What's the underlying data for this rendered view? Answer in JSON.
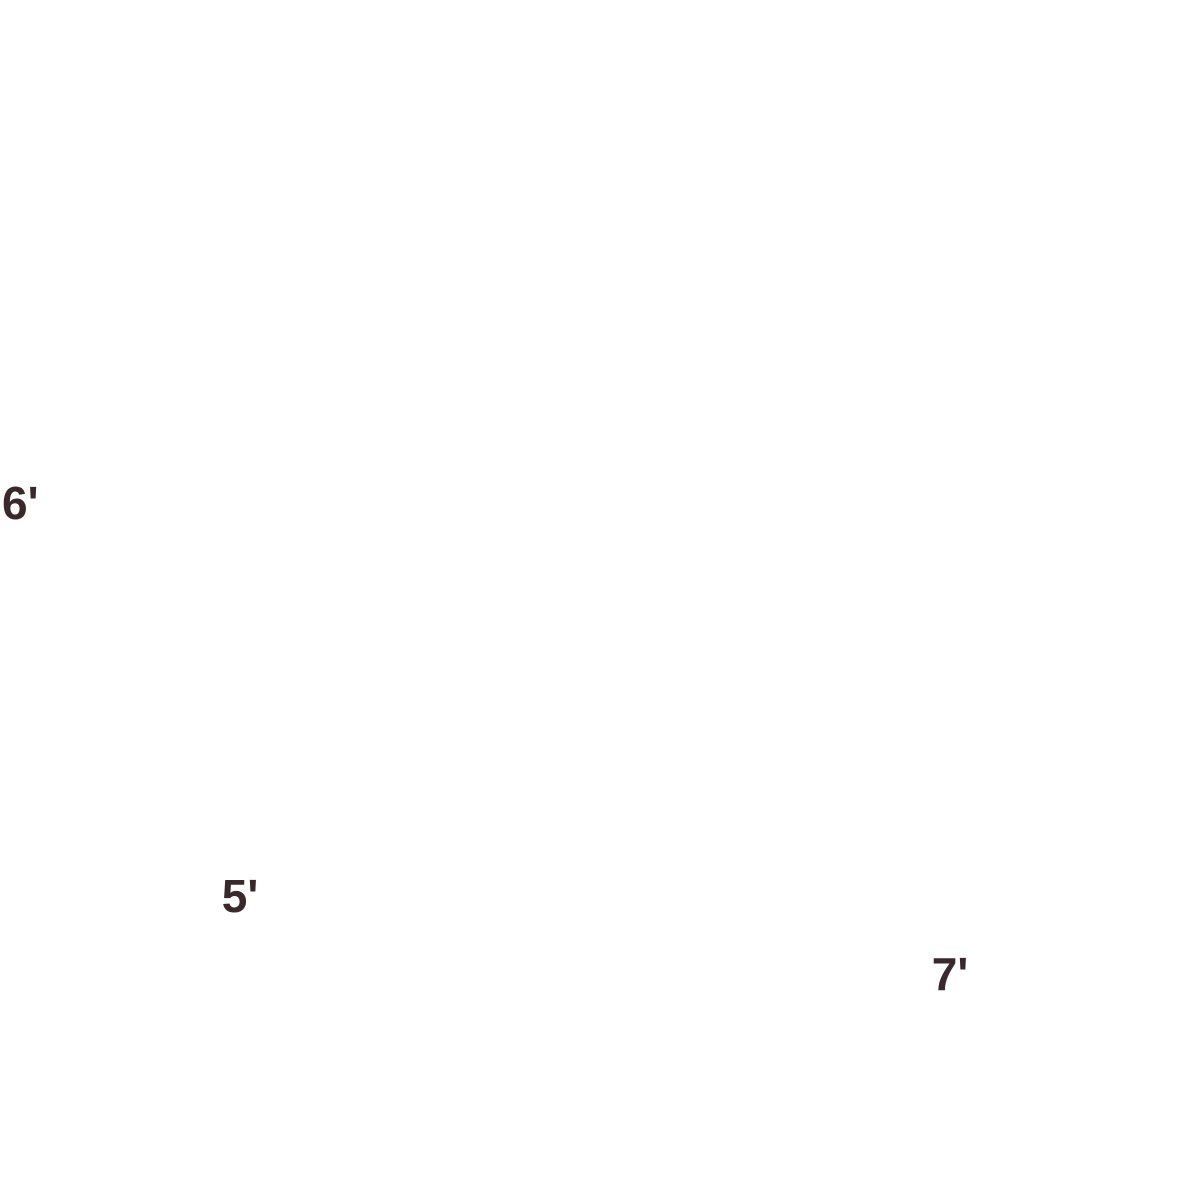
{
  "page": {
    "background_color": "#47704D"
  },
  "illustration": {
    "description": "Isometric cutaway diagram of a red storage unit filled with household items, with dimension arrows",
    "room": {
      "floor": "#F2B5B8",
      "floor_edge": "#C10D17",
      "wall_left": "#8C1016",
      "wall_right": "#A31119",
      "wall_top": "#EF9FA5",
      "wall_cap": "#EC9AA1"
    },
    "dimensions": {
      "height": {
        "label": "6'"
      },
      "depth": {
        "label": "5'"
      },
      "width": {
        "label": "7'"
      },
      "arrow_color": "#E73844",
      "label_color": "#33232A"
    },
    "palette": {
      "wood": {
        "top": "#EBD3A6",
        "light": "#DDBE8E",
        "dark": "#C9A26C",
        "deep": "#B68B55",
        "interior": "#E9D0A0",
        "cream": "#F2E2BC",
        "face": "#E6C795",
        "door": "#E9D1A4",
        "leg": "#C9A266"
      },
      "white": {
        "top": "#F6F3EF",
        "light": "#EFEAE4",
        "dark": "#DFD8D1",
        "deep": "#CBC3BA",
        "slot": "#A89F94"
      },
      "kraft": {
        "top": "#EFD7AC",
        "light": "#E5C48E",
        "dark": "#D4AE74",
        "tape": "#FAF9F5",
        "tape_shade": "#EFEAE0",
        "label": "#E9E7E1"
      },
      "chair": {
        "top": "#88806C",
        "light": "#7C7361",
        "dark": "#6E6553",
        "trim": "#948B76"
      },
      "monitor": {
        "top": "#6A6A62",
        "side": "#5C5C54",
        "front": "#4E4E47"
      },
      "metal": {
        "light": "#F4F2EE",
        "dark": "#C6BFB6",
        "stem": "#BDBAB5"
      },
      "dumbbell": {
        "dark": "#26251F",
        "mid": "#35332F",
        "light": "#4A4842"
      },
      "vacuum": {
        "mid": "#55534B",
        "dark": "#403E37",
        "body": "#4A4840",
        "maroon_top": "#A04E64",
        "maroon_dark": "#7E3A4E",
        "maroon_mid": "#8F4458",
        "grip": "#262421"
      },
      "accent": {
        "teal_top": "#5FCBDE",
        "teal_light": "#45BCD1",
        "teal_dark": "#2FA8BE",
        "salmon_top": "#F2A79F",
        "salmon_light": "#EC938E",
        "salmon_dark": "#E07F7E",
        "maroon_top": "#8A4A63",
        "maroon_light": "#7C415A",
        "maroon_dark": "#6E3850",
        "yellow": "#EFD06E",
        "yellow_dark": "#E3BC4F",
        "ygreen": "#C6C76D",
        "ygreen_dark": "#B2B356",
        "olive_top": "#D3CF8E",
        "olive_light": "#BDBB74",
        "olive_dark": "#9FA05B",
        "pot_top": "#E08298",
        "pot_dark": "#C2556E",
        "pot_light": "#EFA2B0",
        "pot_rim_top": "#F2AEBB",
        "pot_rim_dark": "#CE647C",
        "pot_rim_light": "#F6BCC7",
        "pot_soil": "#6E4247"
      }
    },
    "items": [
      {
        "id": "floor",
        "label": "storage unit floor"
      },
      {
        "id": "left-wall",
        "label": "left wall"
      },
      {
        "id": "right-wall",
        "label": "right wall"
      },
      {
        "id": "white-box-stack-back",
        "label": "stack of white lidded storage boxes"
      },
      {
        "id": "white-box-stack-front",
        "label": "stack of white lidded storage boxes"
      },
      {
        "id": "credenza-cabinet",
        "label": "low wooden cabinet with drawers"
      },
      {
        "id": "table-lamp",
        "label": "white table lamp"
      },
      {
        "id": "drawer-box-stack-left",
        "label": "stack of white drawer boxes"
      },
      {
        "id": "drawer-box-stack-right",
        "label": "stack of white drawer boxes"
      },
      {
        "id": "open-box",
        "label": "open white box"
      },
      {
        "id": "bookcase",
        "label": "wooden bookcase with empty shelves"
      },
      {
        "id": "wall-shelf-unit",
        "label": "wall shelf unit with colored boxes and books"
      },
      {
        "id": "cardboard-box-stack",
        "label": "stacked cardboard moving boxes with tape"
      },
      {
        "id": "desk",
        "label": "wooden desk with drawers"
      },
      {
        "id": "computer-monitor",
        "label": "computer monitor"
      },
      {
        "id": "keyboard",
        "label": "keyboard"
      },
      {
        "id": "nightstand",
        "label": "wooden nightstand"
      },
      {
        "id": "dumbbell-rack",
        "label": "dumbbell rack with black dumbbells"
      },
      {
        "id": "wardrobe",
        "label": "wooden wardrobe cabinet"
      },
      {
        "id": "cube-shelf",
        "label": "cube bookshelf with books and boxes"
      },
      {
        "id": "planter-lamp",
        "label": "lamp in pink planter"
      },
      {
        "id": "vacuum-cleaner",
        "label": "upright vacuum cleaner"
      },
      {
        "id": "chest-of-drawers",
        "label": "white chest of drawers"
      },
      {
        "id": "stool",
        "label": "wooden stool"
      },
      {
        "id": "armchair",
        "label": "dark upholstered armchair"
      },
      {
        "id": "height-arrow",
        "label": "height dimension arrow"
      },
      {
        "id": "depth-arrow",
        "label": "depth dimension arrow"
      },
      {
        "id": "width-arrow",
        "label": "width dimension arrow"
      }
    ]
  }
}
